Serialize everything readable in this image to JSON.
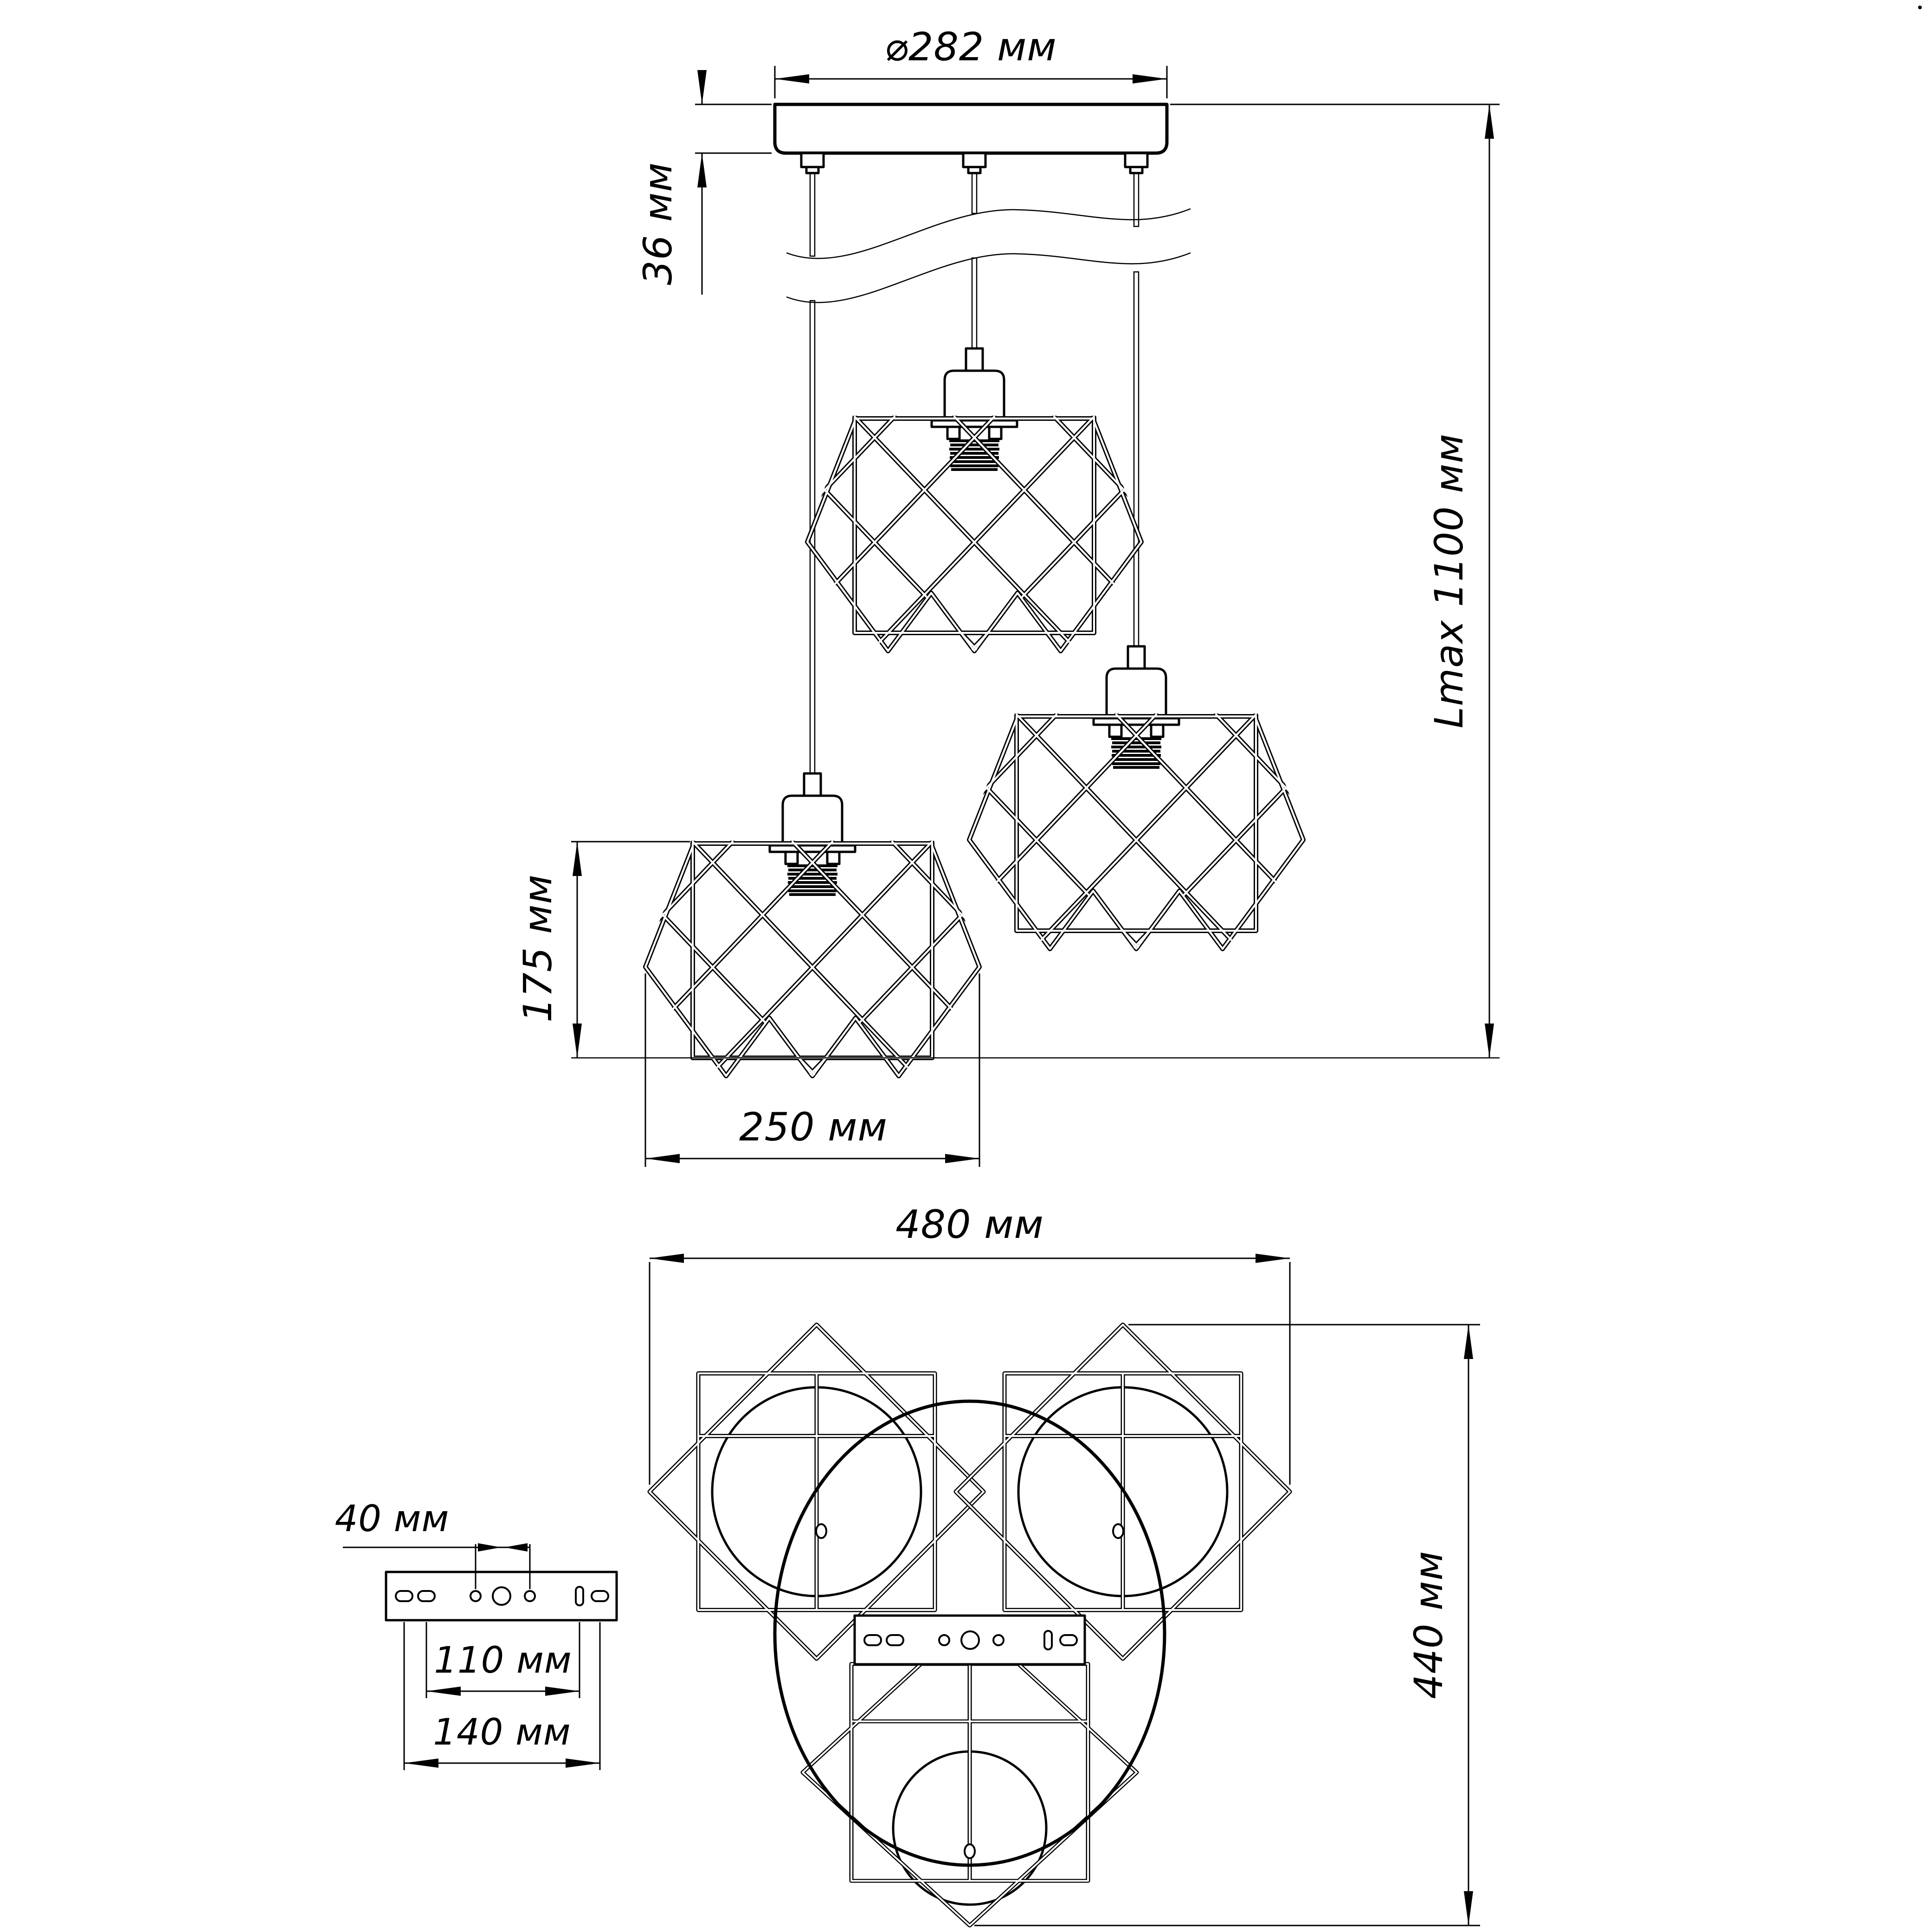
{
  "drawing": {
    "front_view": {
      "dim_canopy_diameter": "⌀282 мм",
      "dim_canopy_height": "36 мм",
      "dim_max_length": "Lmax 1100 мм",
      "dim_shade_height": "175 мм",
      "dim_shade_width": "250 мм"
    },
    "plan_view": {
      "dim_overall_width": "480 мм",
      "dim_overall_depth": "440 мм"
    },
    "bracket_detail": {
      "dim_center_holes": "40 мм",
      "dim_inner_holes": "110 мм",
      "dim_outer_holes": "140 мм"
    },
    "colors": {
      "line": "#000000",
      "background": "#ffffff"
    }
  }
}
